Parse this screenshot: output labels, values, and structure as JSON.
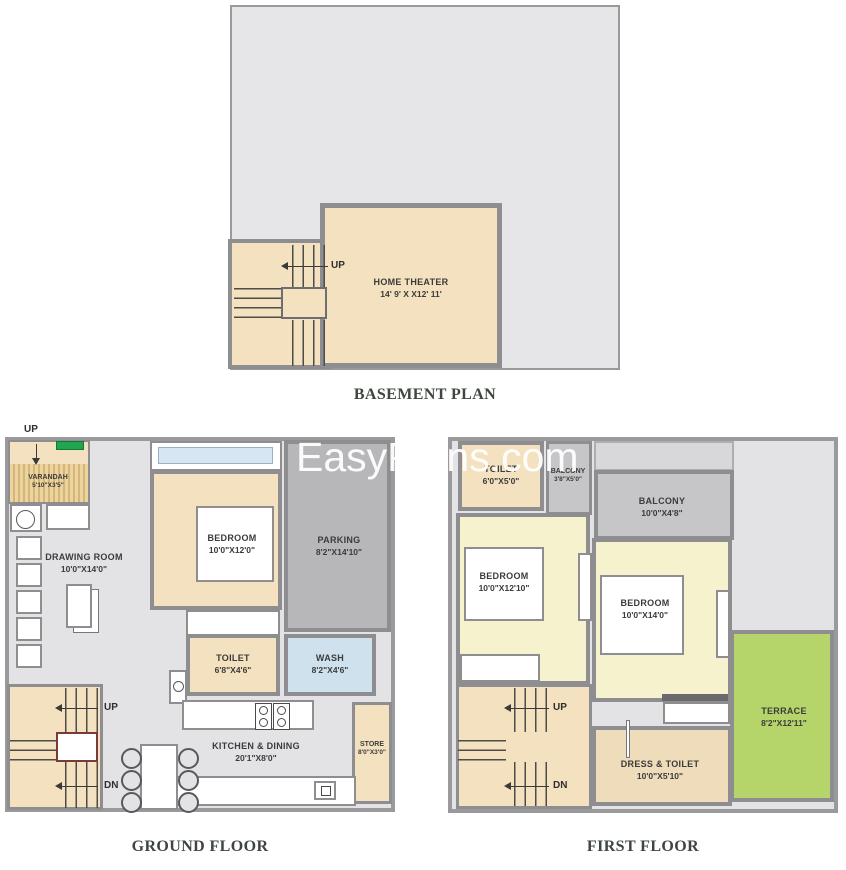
{
  "watermark": "EasyPlans.com",
  "colors": {
    "wall": "#8e8e90",
    "outer_wall": "#9a9a9c",
    "floor_bg": "#e3e3e5",
    "beige": "#f3e1bf",
    "beige_dark": "#eedcba",
    "pale_yellow": "#f6f2ce",
    "parking_gray": "#b7b7b9",
    "balcony_gray": "#c6c6c8",
    "wash_blue": "#cfe1ec",
    "window_blue": "#d6e6f2",
    "terrace_green": "#b5d46a",
    "planter_green": "#21a551",
    "landing_red": "#7a3a38",
    "title": "#3e463e",
    "watermark": "#ffffff"
  },
  "plans": {
    "basement": {
      "title": "BASEMENT PLAN",
      "up": "UP",
      "home_theater": {
        "name": "HOME THEATER",
        "dims": "14' 9' X X12' 11'"
      }
    },
    "ground": {
      "title": "GROUND FLOOR",
      "entry_up": "UP",
      "up": "UP",
      "dn": "DN",
      "varandah": {
        "name": "VARANDAH",
        "dims": "5'10\"X3'5\""
      },
      "drawing_room": {
        "name": "DRAWING ROOM",
        "dims": "10'0\"X14'0\""
      },
      "bedroom": {
        "name": "BEDROOM",
        "dims": "10'0\"X12'0\""
      },
      "parking": {
        "name": "PARKING",
        "dims": "8'2\"X14'10\""
      },
      "toilet": {
        "name": "TOILET",
        "dims": "6'8\"X4'6\""
      },
      "wash": {
        "name": "WASH",
        "dims": "8'2\"X4'6\""
      },
      "kitchen_dining": {
        "name": "KITCHEN & DINING",
        "dims": "20'1\"X8'0\""
      },
      "store": {
        "name": "STORE",
        "dims": "8'0\"X3'0\""
      }
    },
    "first": {
      "title": "FIRST FLOOR",
      "up": "UP",
      "dn": "DN",
      "toilet": {
        "name": "TOILET",
        "dims": "6'0\"X5'0\""
      },
      "balcony_small": {
        "name": "BALCONY",
        "dims": "3'8\"X5'0\""
      },
      "balcony_large": {
        "name": "BALCONY",
        "dims": "10'0\"X4'8\""
      },
      "bedroom_left": {
        "name": "BEDROOM",
        "dims": "10'0\"X12'10\""
      },
      "bedroom_right": {
        "name": "BEDROOM",
        "dims": "10'0\"X14'0\""
      },
      "terrace": {
        "name": "TERRACE",
        "dims": "8'2\"X12'11\""
      },
      "dress_toilet": {
        "name": "DRESS & TOILET",
        "dims": "10'0\"X5'10\""
      }
    }
  }
}
